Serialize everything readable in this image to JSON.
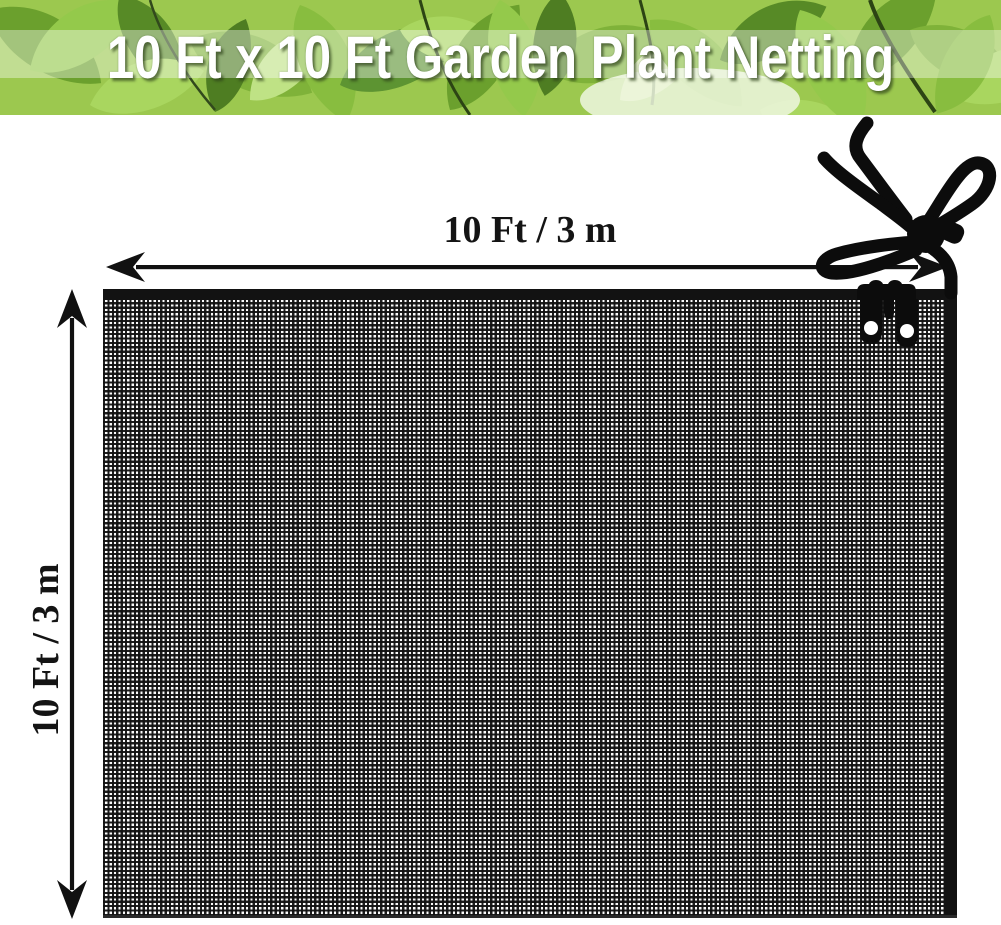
{
  "banner": {
    "title": "10 Ft x 10 Ft Garden Plant Netting"
  },
  "dimension_labels": {
    "width": "10 Ft / 3 m",
    "height": "10 Ft / 3 m"
  },
  "net": {
    "description": "black fine-mesh garden plant netting",
    "mesh_color": "#161616"
  },
  "accessories": {
    "tie_cord": "drawstring-cord-with-toggle",
    "clips": "netting-clip-with-eyelets"
  },
  "colors": {
    "background": "#ffffff",
    "annotation_ink": "#111111",
    "banner_text": "#ffffff",
    "leaf_light": "#a9d65f",
    "leaf_dark": "#578a26"
  }
}
